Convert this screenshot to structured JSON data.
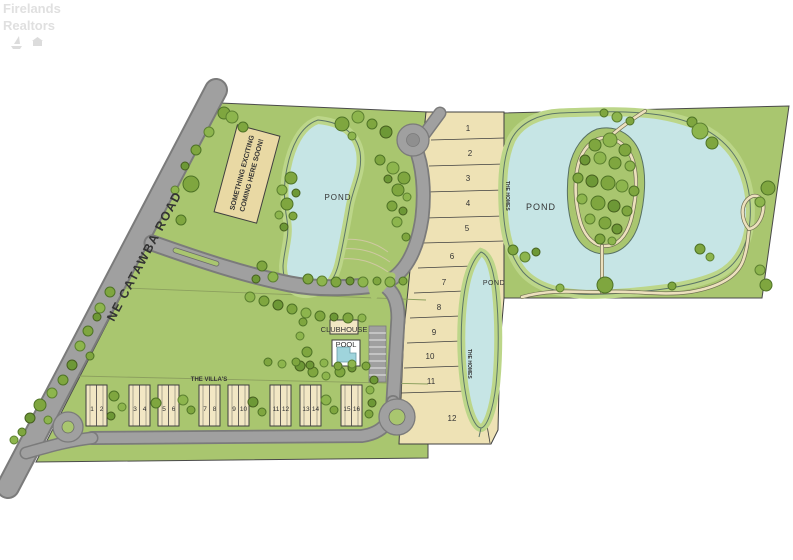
{
  "watermark": {
    "line1": "Firelands",
    "line2": "Realtors"
  },
  "road_label": "NE CATAWBA ROAD",
  "sign": {
    "line1": "SOMETHING EXCITING",
    "line2": "COMING HERE SOON!"
  },
  "ponds": {
    "left": "POND",
    "middle": "POND",
    "right": "POND"
  },
  "homes_label_upper": "THE HOMES",
  "homes_label_lower": "THE HOMES",
  "clubhouse_label": "CLUBHOUSE",
  "pool_label": "POOL",
  "villas": {
    "label": "THE VILLA'S",
    "units": [
      "1",
      "2",
      "3",
      "4",
      "5",
      "6",
      "7",
      "8",
      "9",
      "10",
      "11",
      "12",
      "13",
      "14",
      "15",
      "16"
    ]
  },
  "lots": [
    "1",
    "2",
    "3",
    "4",
    "5",
    "6",
    "7",
    "8",
    "9",
    "10",
    "11",
    "12"
  ],
  "colors": {
    "grass": "#a9c66f",
    "lots": "#eee2b5",
    "water": "#c6e5e5",
    "road": "#a0a0a0",
    "roadEdge": "#7b7b7b",
    "fringe": "#bcd689",
    "outline": "#3f3f3f",
    "path": "#ece0bd",
    "sign": "#e9d9a4",
    "building": "#f2e7c4",
    "label": "#333333"
  }
}
